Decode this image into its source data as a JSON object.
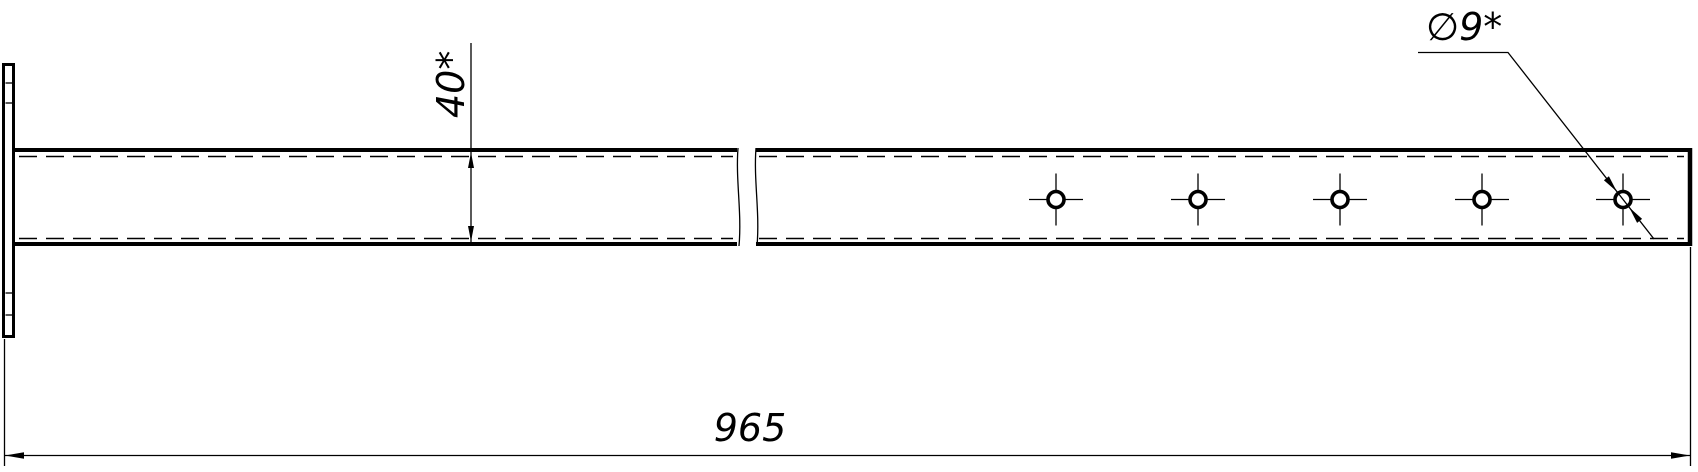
{
  "labels": {
    "height_dimension": "40*",
    "length_dimension": "965",
    "hole_diameter": "∅9*"
  },
  "holes": {
    "count": 5,
    "centers_x": [
      1056,
      1198,
      1340,
      1482,
      1623
    ],
    "center_y": 199.5,
    "radius": 8,
    "centerline_extent_h": 27,
    "centerline_extent_v": 26
  },
  "colors": {
    "line": "#000000",
    "background": "#ffffff"
  }
}
